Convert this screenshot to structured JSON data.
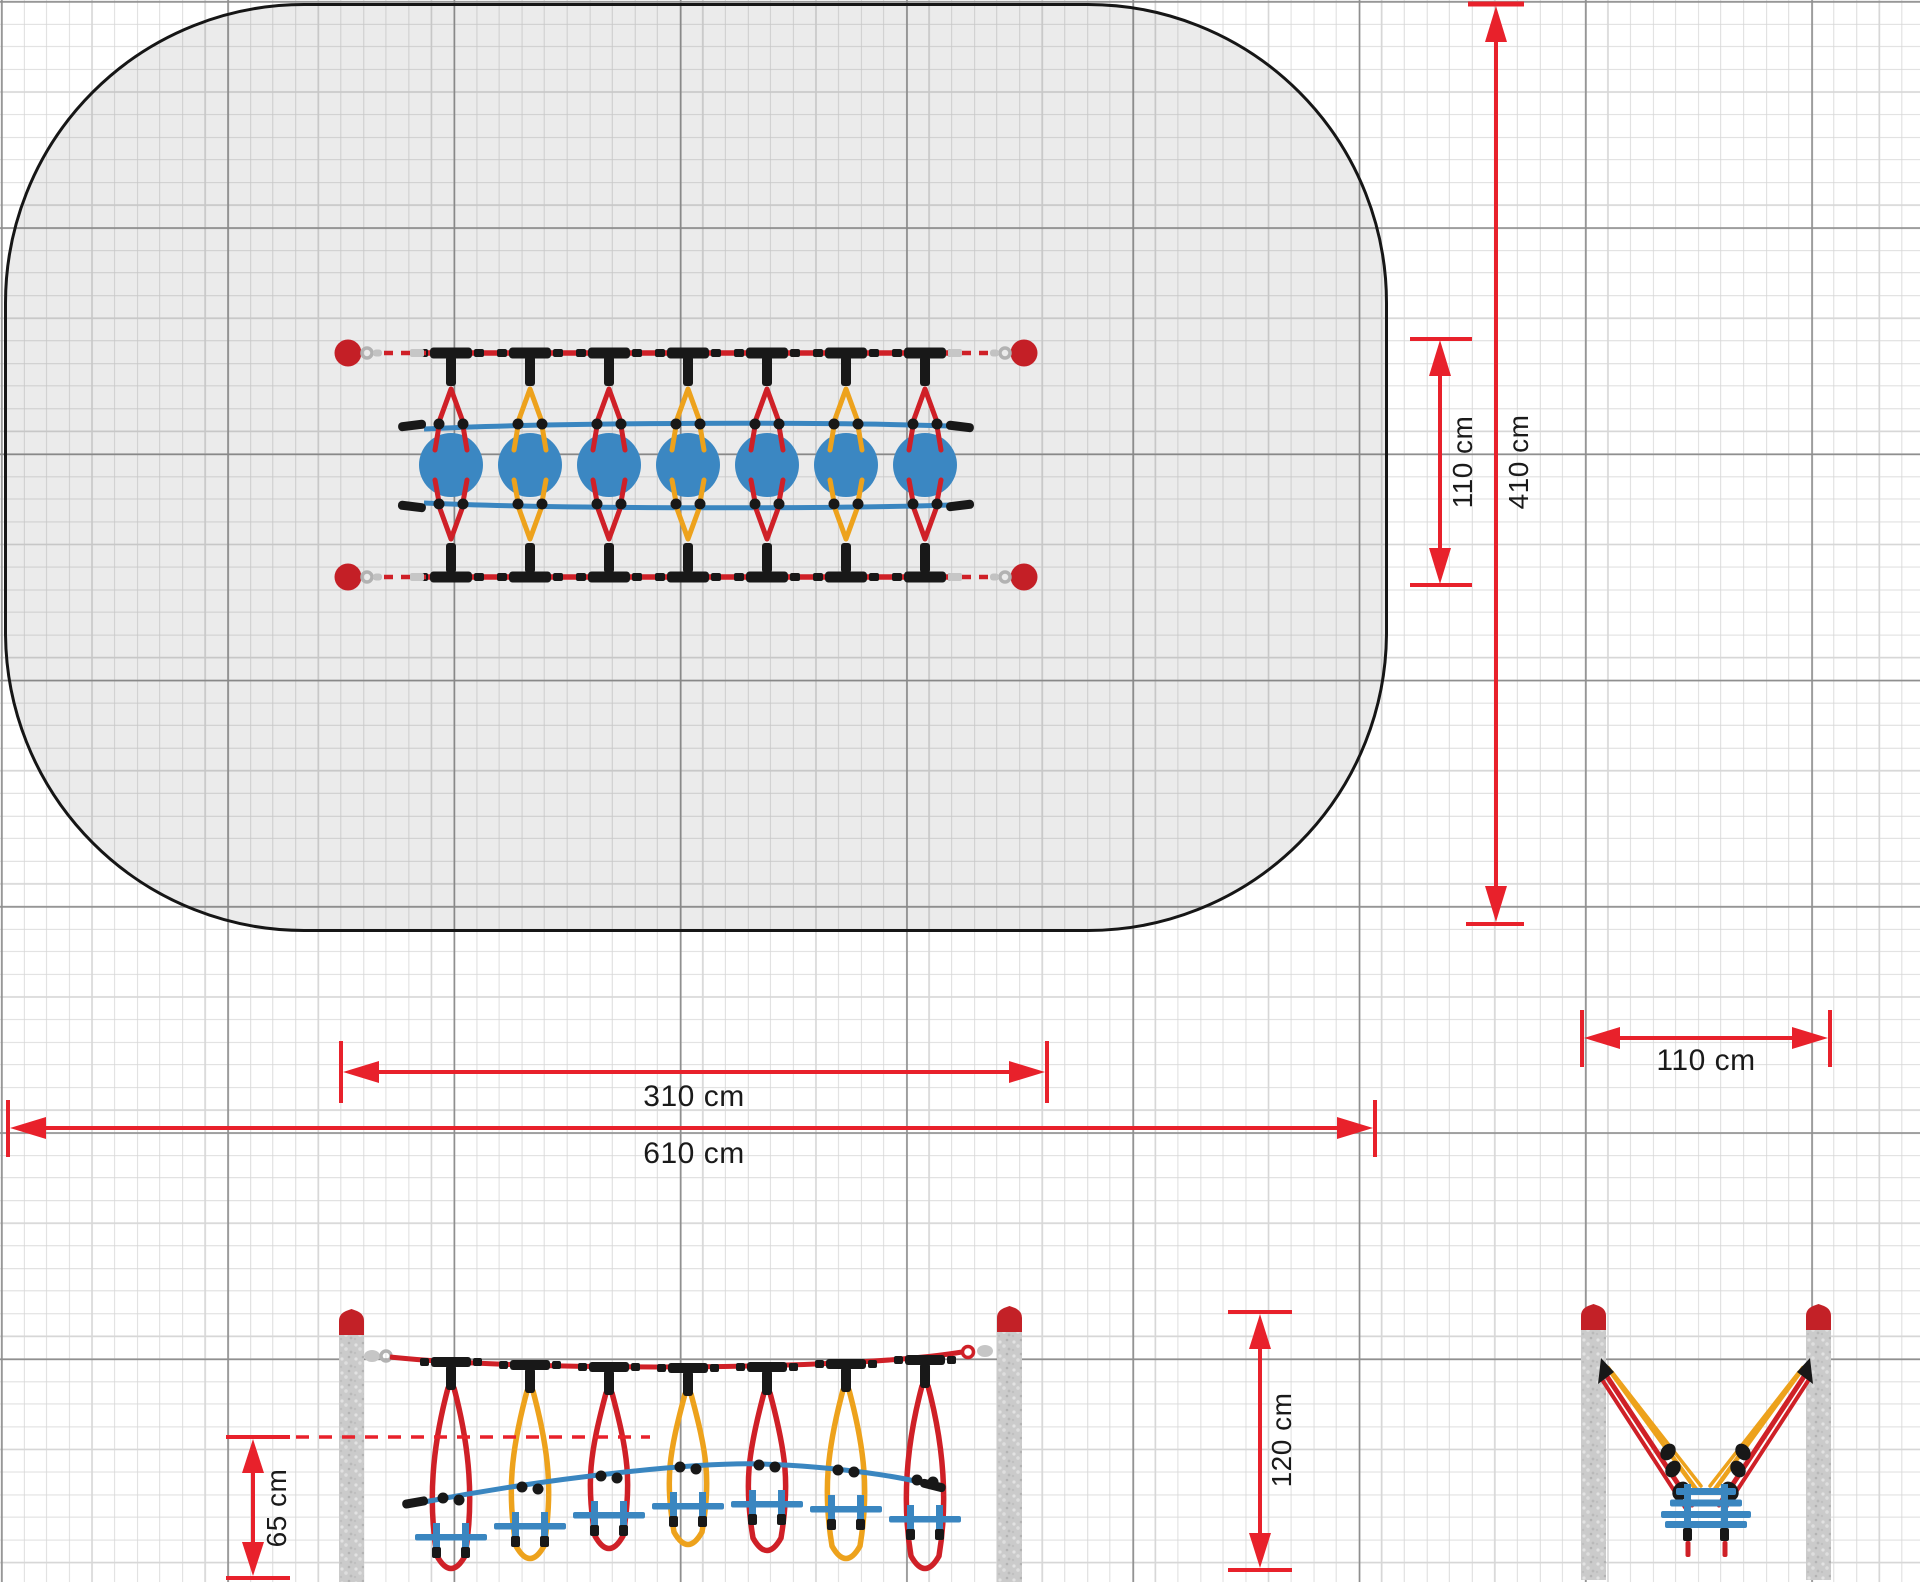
{
  "dimensions": {
    "plan_equipment_width": "110 cm",
    "safety_zone_height": "410 cm",
    "equipment_length": "310 cm",
    "safety_zone_length": "610 cm",
    "end_view_post_spacing": "110 cm",
    "fall_height": "65 cm",
    "post_height": "120 cm"
  },
  "equipment": {
    "disc_count": 7,
    "plan_post_count": 4,
    "module_rope_colors": [
      "red",
      "yellow",
      "red",
      "yellow",
      "red",
      "yellow",
      "red"
    ]
  },
  "colors": {
    "dimension_red": "#e8212b",
    "rope_red": "#cf2027",
    "rope_yellow": "#eda21c",
    "rope_blue": "#3a86c0",
    "connector_black": "#181818",
    "post_gray": "#cbcbcb",
    "post_cap_red": "#c32127",
    "safety_zone_fill": "#e8e8e8"
  }
}
